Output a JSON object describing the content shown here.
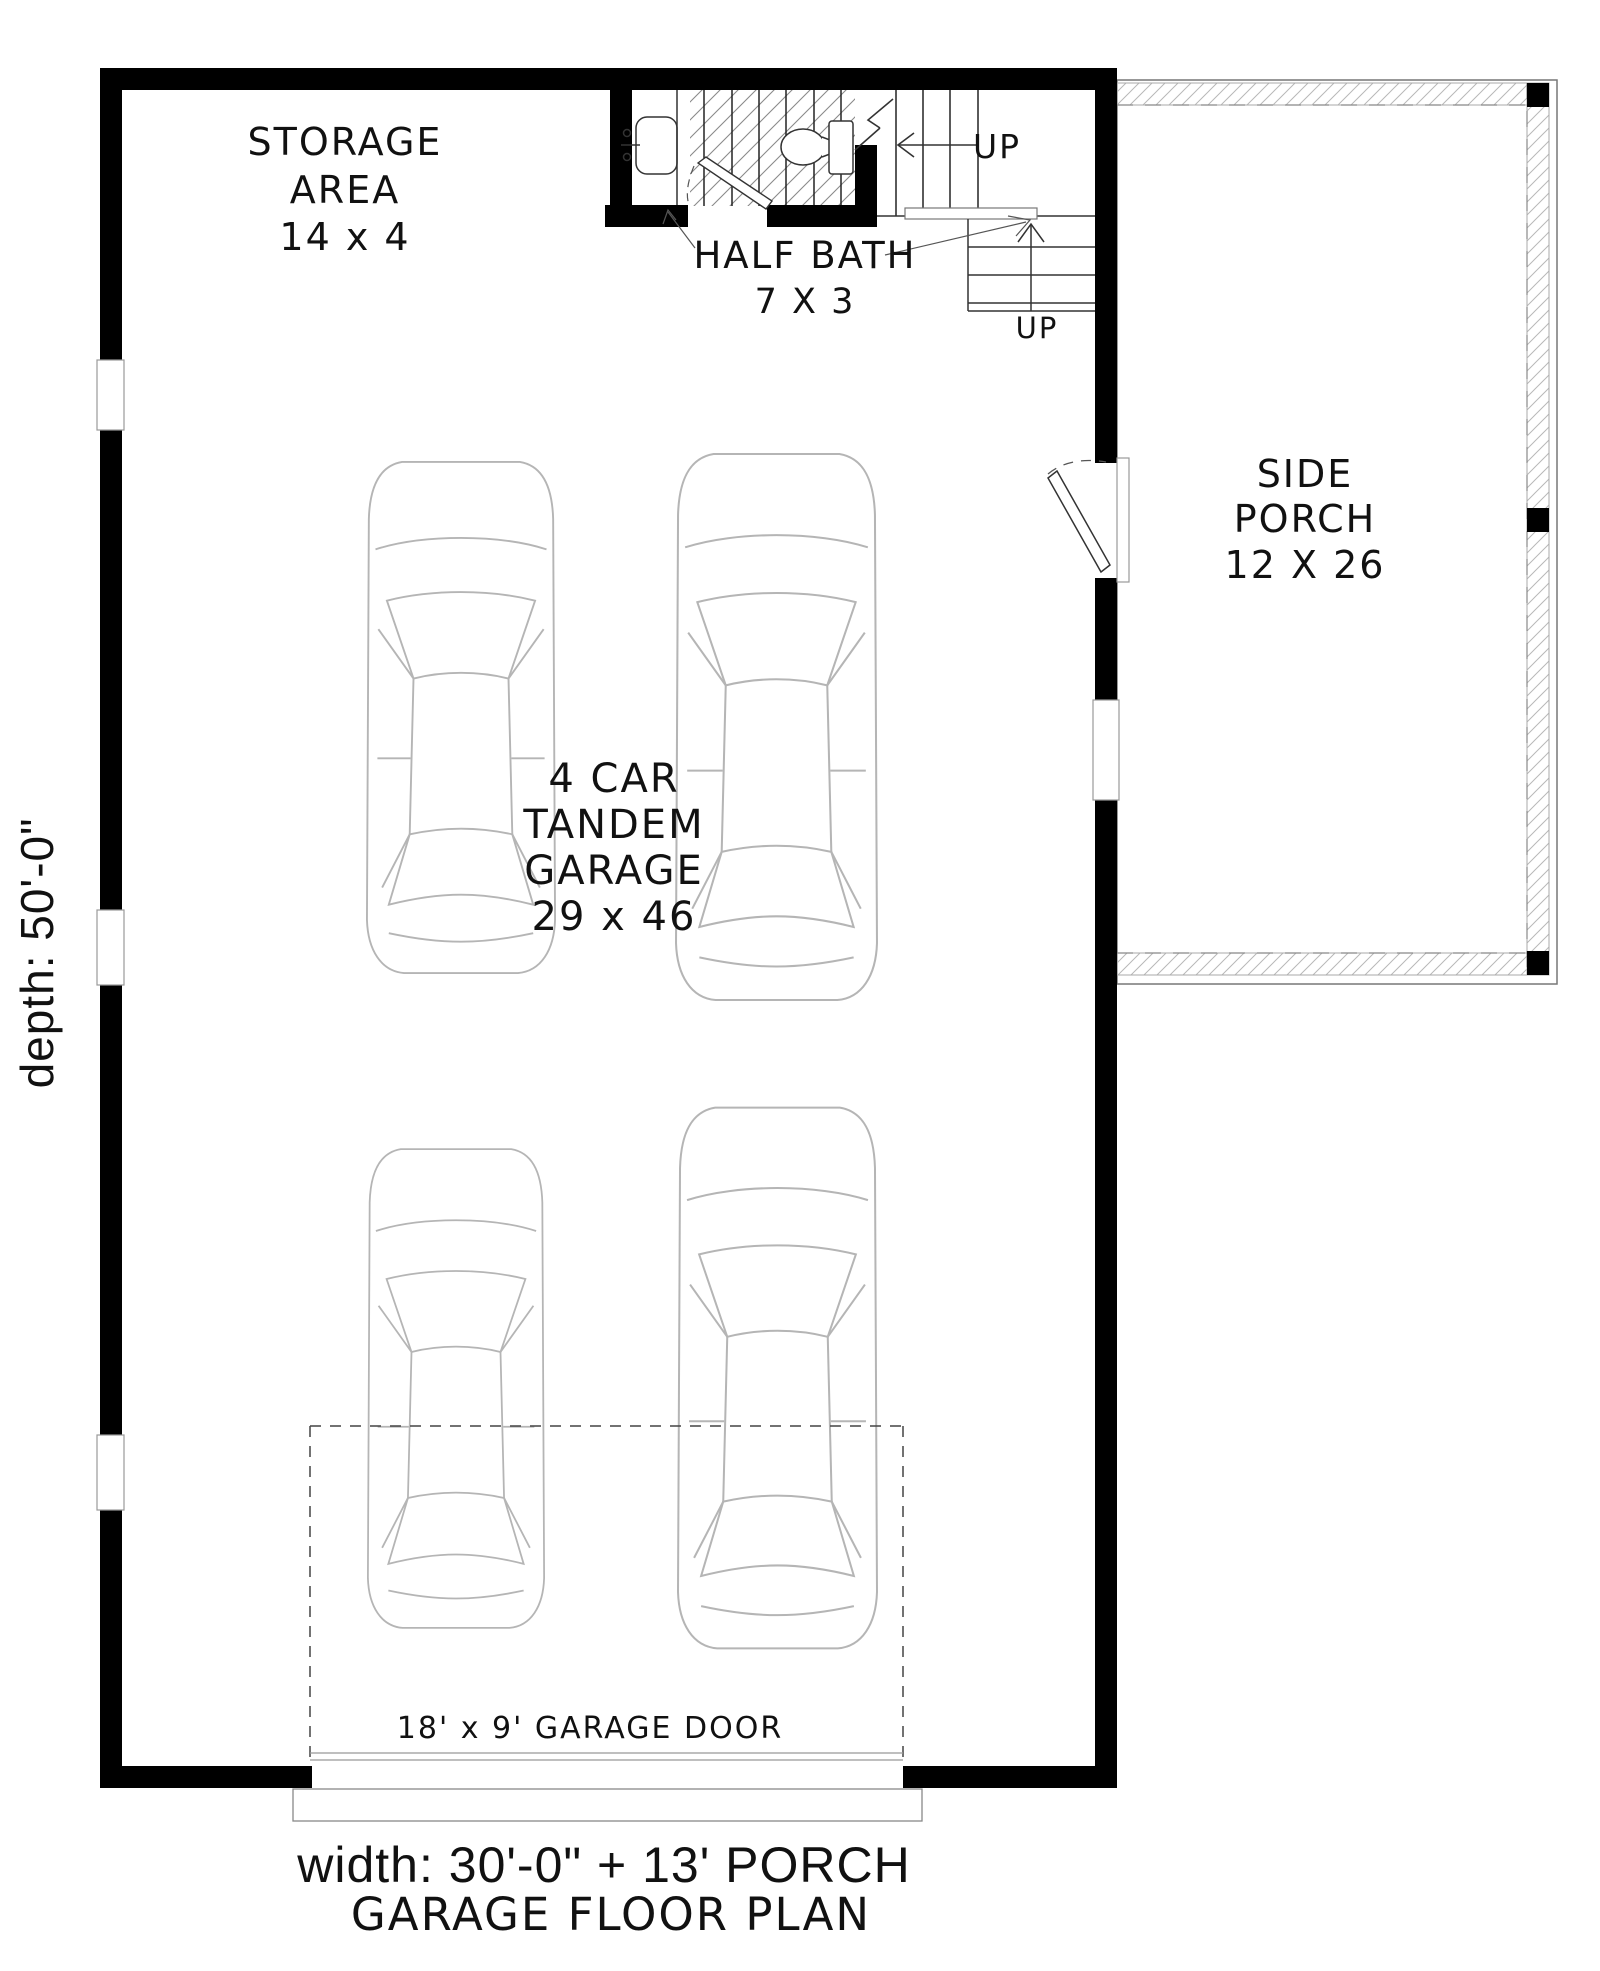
{
  "plan": {
    "title": "GARAGE FLOOR PLAN",
    "width_label": "width: 30'-0\" + 13' PORCH",
    "depth_label": "depth: 50'-0\"",
    "garage_door_label": "18' x 9' GARAGE DOOR",
    "rooms": {
      "storage": {
        "line1": "STORAGE",
        "line2": "AREA",
        "size": "14 x 4"
      },
      "half_bath": {
        "line1": "HALF BATH",
        "size": "7 X 3"
      },
      "side_porch": {
        "line1": "SIDE",
        "line2": "PORCH",
        "size": "12 X 26"
      },
      "garage": {
        "line1": "4 CAR",
        "line2": "TANDEM",
        "line3": "GARAGE",
        "size": "29 x 46"
      }
    },
    "stairs": {
      "up1": "UP",
      "up2": "UP"
    }
  },
  "colors": {
    "wall": "#000000",
    "background": "#ffffff",
    "car_outline": "#b5b5b5",
    "hatch_understair": "#8a8a8a",
    "hatch_porch": "#b8b8b8"
  }
}
